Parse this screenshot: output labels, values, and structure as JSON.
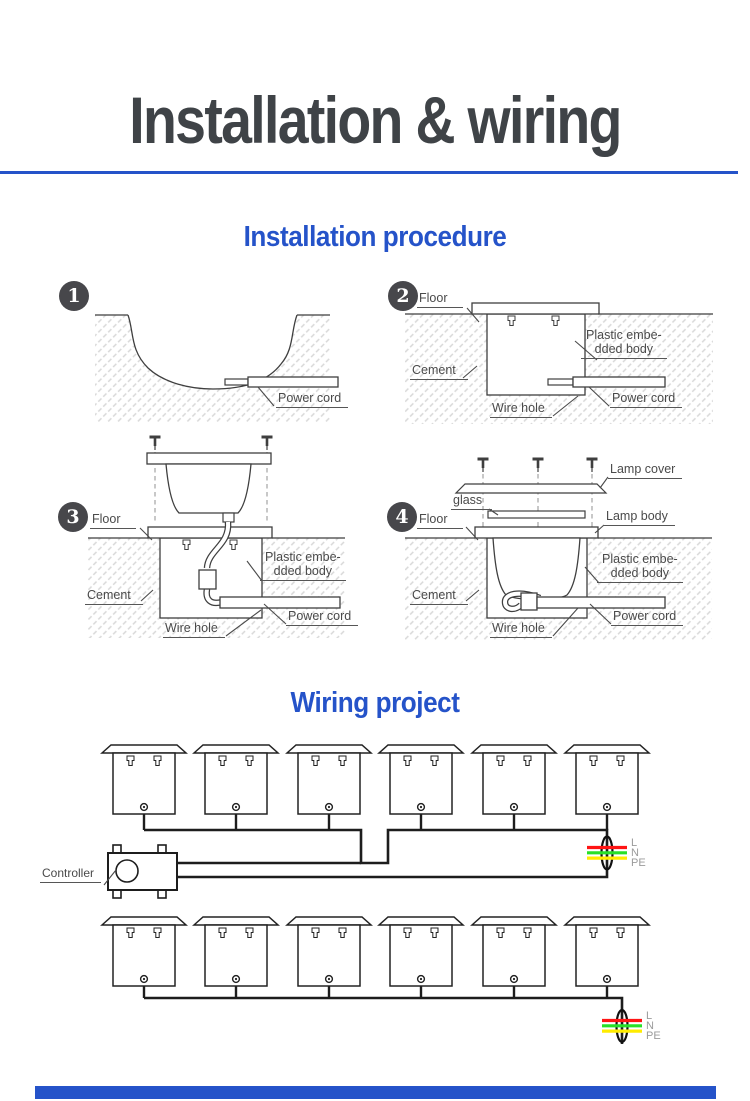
{
  "header": {
    "title": "Installation & wiring"
  },
  "sections": {
    "installation": "Installation procedure",
    "wiring": "Wiring project"
  },
  "step_numbers": [
    "1",
    "2",
    "3",
    "4"
  ],
  "labels": {
    "floor": "Floor",
    "cement": "Cement",
    "wire_hole": "Wire hole",
    "power_cord": "Power cord",
    "plastic_1": "Plastic embe-",
    "plastic_2": "dded body",
    "lamp_cover": "Lamp cover",
    "glass": "glass",
    "lamp_body": "Lamp body",
    "controller": "Controller"
  },
  "wiring": {
    "lamps_per_row": 6,
    "rows": 2,
    "wire_labels": [
      "L",
      "N",
      "PE"
    ],
    "wire_colors": [
      "#ff1414",
      "#28e028",
      "#ffec00"
    ]
  },
  "colors": {
    "accent_blue": "#2553c9",
    "title_gray": "#3f4347",
    "line_art": "#3f3f3f",
    "wiring_line": "#1d1d1d"
  }
}
